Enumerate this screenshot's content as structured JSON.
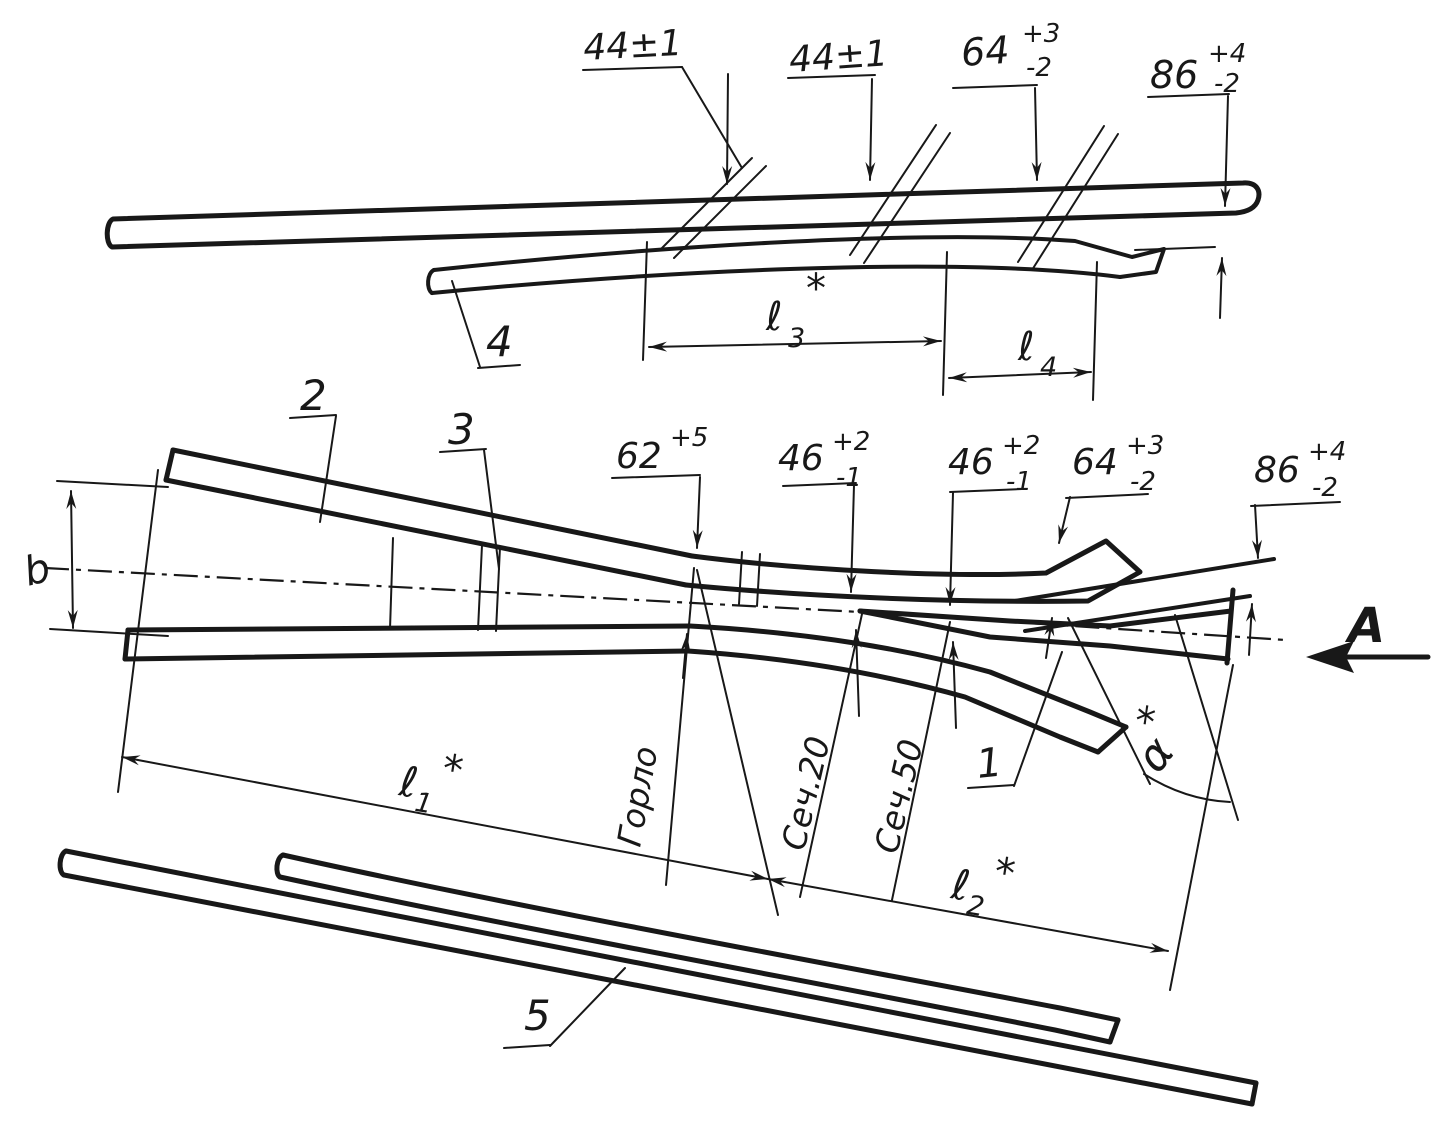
{
  "top_view": {
    "dims": {
      "d44a": {
        "value": "44±1"
      },
      "d44b": {
        "value": "44±1"
      },
      "d64": {
        "value": "64",
        "plus": "+3",
        "minus": "-2"
      },
      "d86": {
        "value": "86",
        "plus": "+4",
        "minus": "-2"
      },
      "l3": {
        "base": "ℓ",
        "sub": "3",
        "star": "*"
      },
      "l4": {
        "base": "ℓ",
        "sub": "4"
      }
    },
    "part4": "4"
  },
  "main_view": {
    "dims": {
      "d62": {
        "value": "62",
        "plus": "+5"
      },
      "d46a": {
        "value": "46",
        "plus": "+2",
        "minus": "-1"
      },
      "d46b": {
        "value": "46",
        "plus": "+2",
        "minus": "-1"
      },
      "d64": {
        "value": "64",
        "plus": "+3",
        "minus": "-2"
      },
      "d86": {
        "value": "86",
        "plus": "+4",
        "minus": "-2"
      },
      "l1": {
        "base": "ℓ",
        "sub": "1",
        "star": "*"
      },
      "l2": {
        "base": "ℓ",
        "sub": "2",
        "star": "*"
      },
      "b": "b",
      "alpha": {
        "base": "α",
        "star": "*"
      }
    },
    "sections": {
      "throat": "Горло",
      "s20": "Сеч.20",
      "s50": "Сеч.50"
    },
    "parts": {
      "p1": "1",
      "p2": "2",
      "p3": "3"
    },
    "view_arrow": "A"
  },
  "bottom_view": {
    "part5": "5"
  }
}
